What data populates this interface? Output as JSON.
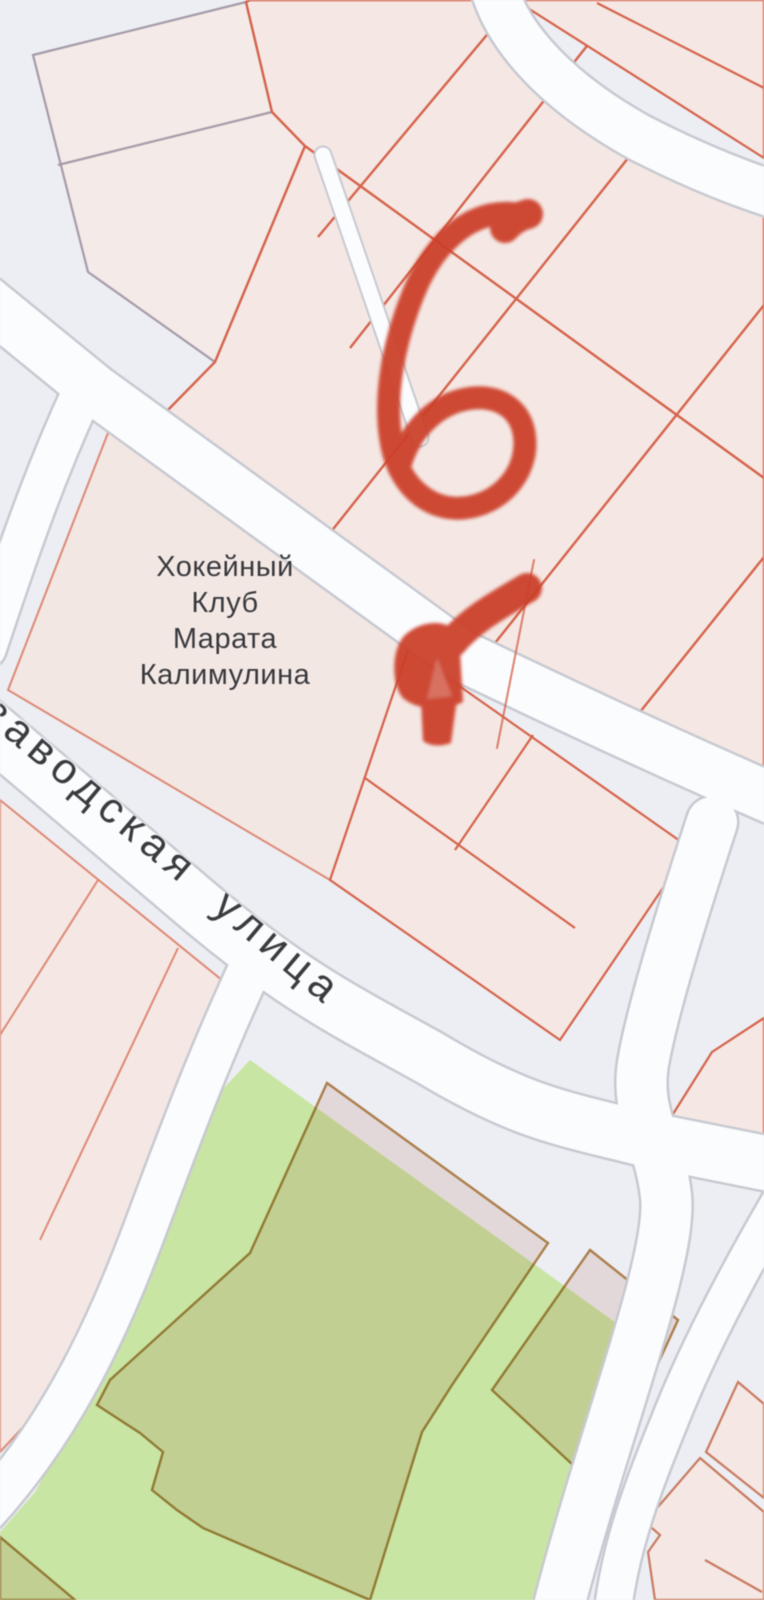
{
  "map": {
    "view": "cadastral-parcel-map",
    "poi": {
      "line1": "Хокейный",
      "line2": "Клуб",
      "line3": "Марата",
      "line4": "Калимулина"
    },
    "street": {
      "partial_prefix": "о",
      "name": "заводская улица"
    },
    "annotations": {
      "spiral": "hand-drawn red G-shaped marker scribble",
      "arrow": "hand-drawn red marker arrow pointing down-left"
    },
    "palette": {
      "background": "#edeef3",
      "road_fill": "#fbfcfe",
      "road_casing": "#c7c9d1",
      "parcel_fill": "#f5e8e4",
      "parcel_outline_strong": "#d5624a",
      "parcel_outline_soft": "#dd8874",
      "pentagon_outline": "#a59aa9",
      "green_area": "#c9e5a3",
      "green_parcel_outline": "#b8874f",
      "annotation_red": "#cc402a",
      "label_color": "#38373b"
    }
  }
}
